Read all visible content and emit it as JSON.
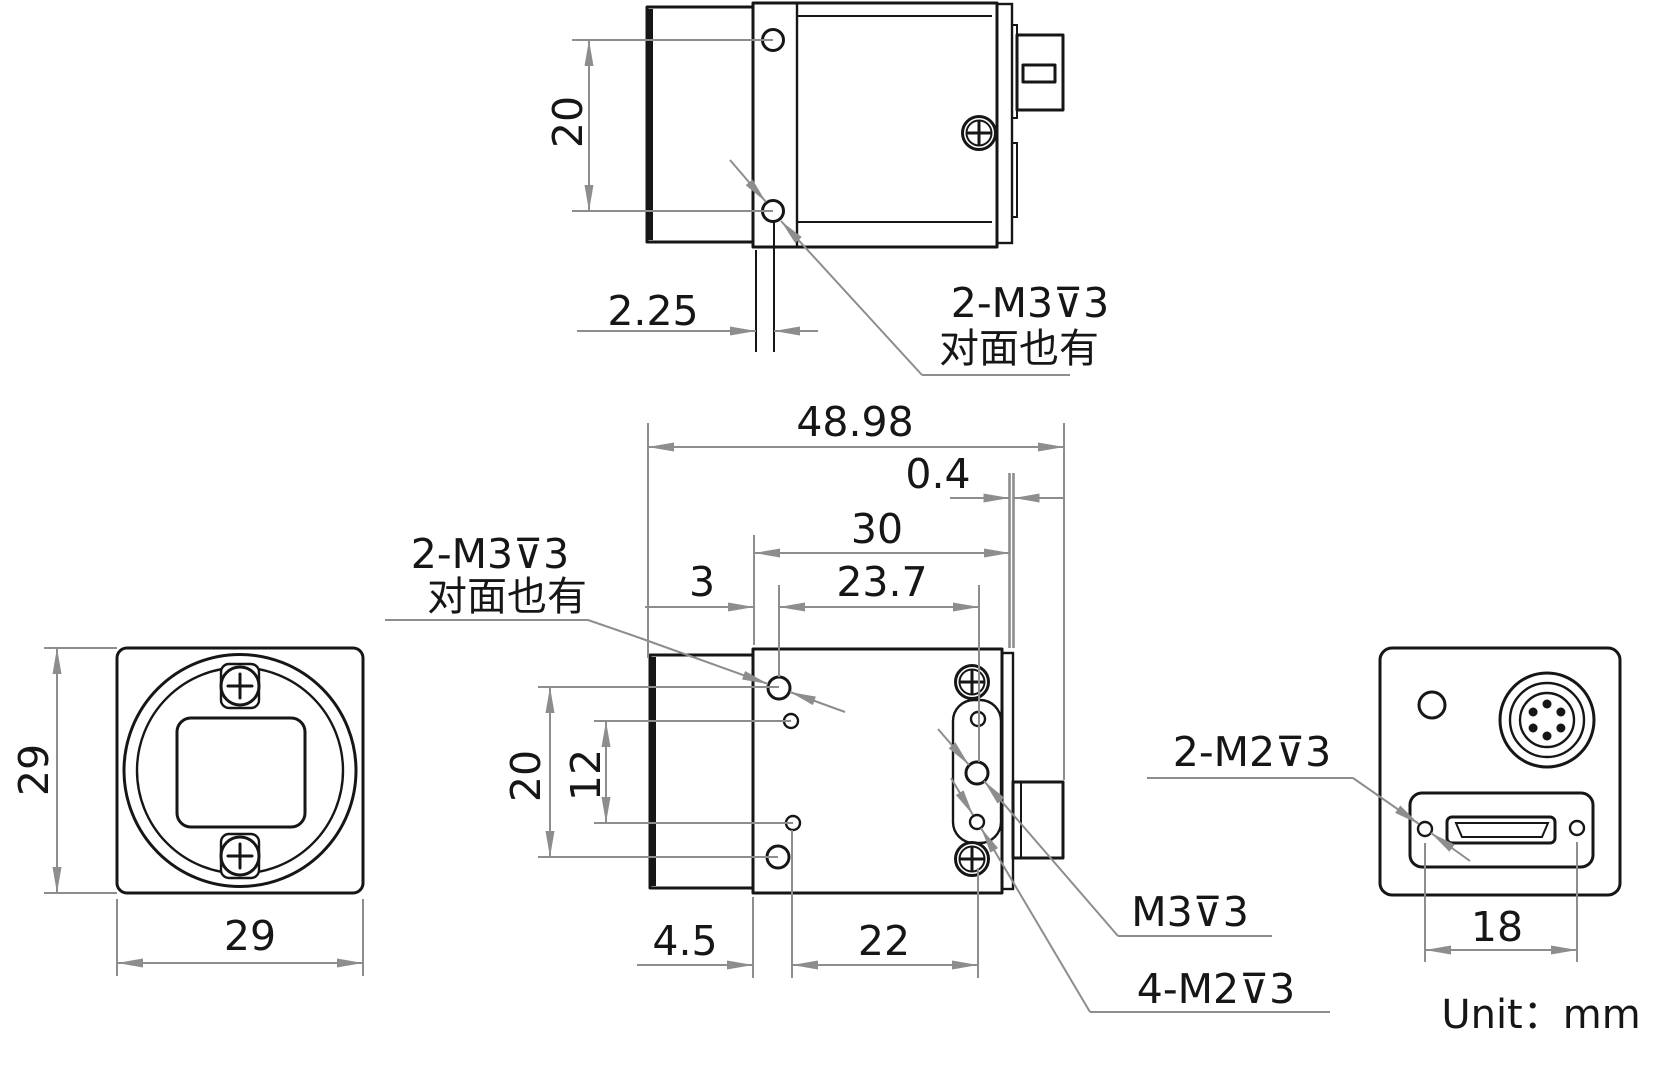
{
  "drawing": {
    "unit_label": "Unit：mm",
    "colors": {
      "line": "#161616",
      "dimension": "#8d8d8d",
      "background": "#ffffff"
    },
    "top_view": {
      "dim_hole_spacing": "20",
      "dim_hole_offset": "2.25",
      "thread_label_line1": "2-M3⊽3",
      "thread_label_line2": "对面也有"
    },
    "front_view": {
      "dim_height": "29",
      "dim_width": "29"
    },
    "side_view": {
      "dim_total_length": "48.98",
      "dim_rear_gap": "0.4",
      "dim_body_length": "30",
      "dim_front_hole_offset": "3",
      "dim_hole_span": "23.7",
      "dim_mount_hole_spacing": "20",
      "dim_aux_hole_spacing": "12",
      "dim_bottom_offset": "4.5",
      "dim_bottom_span": "22",
      "thread_label_line1": "2-M3⊽3",
      "thread_label_line2": "对面也有",
      "rear_center_thread_label": "M3⊽3",
      "rear_aux_thread_label": "4-M2⊽3"
    },
    "rear_view": {
      "dim_hole_spacing": "18",
      "panel_thread_label": "2-M2⊽3"
    }
  }
}
